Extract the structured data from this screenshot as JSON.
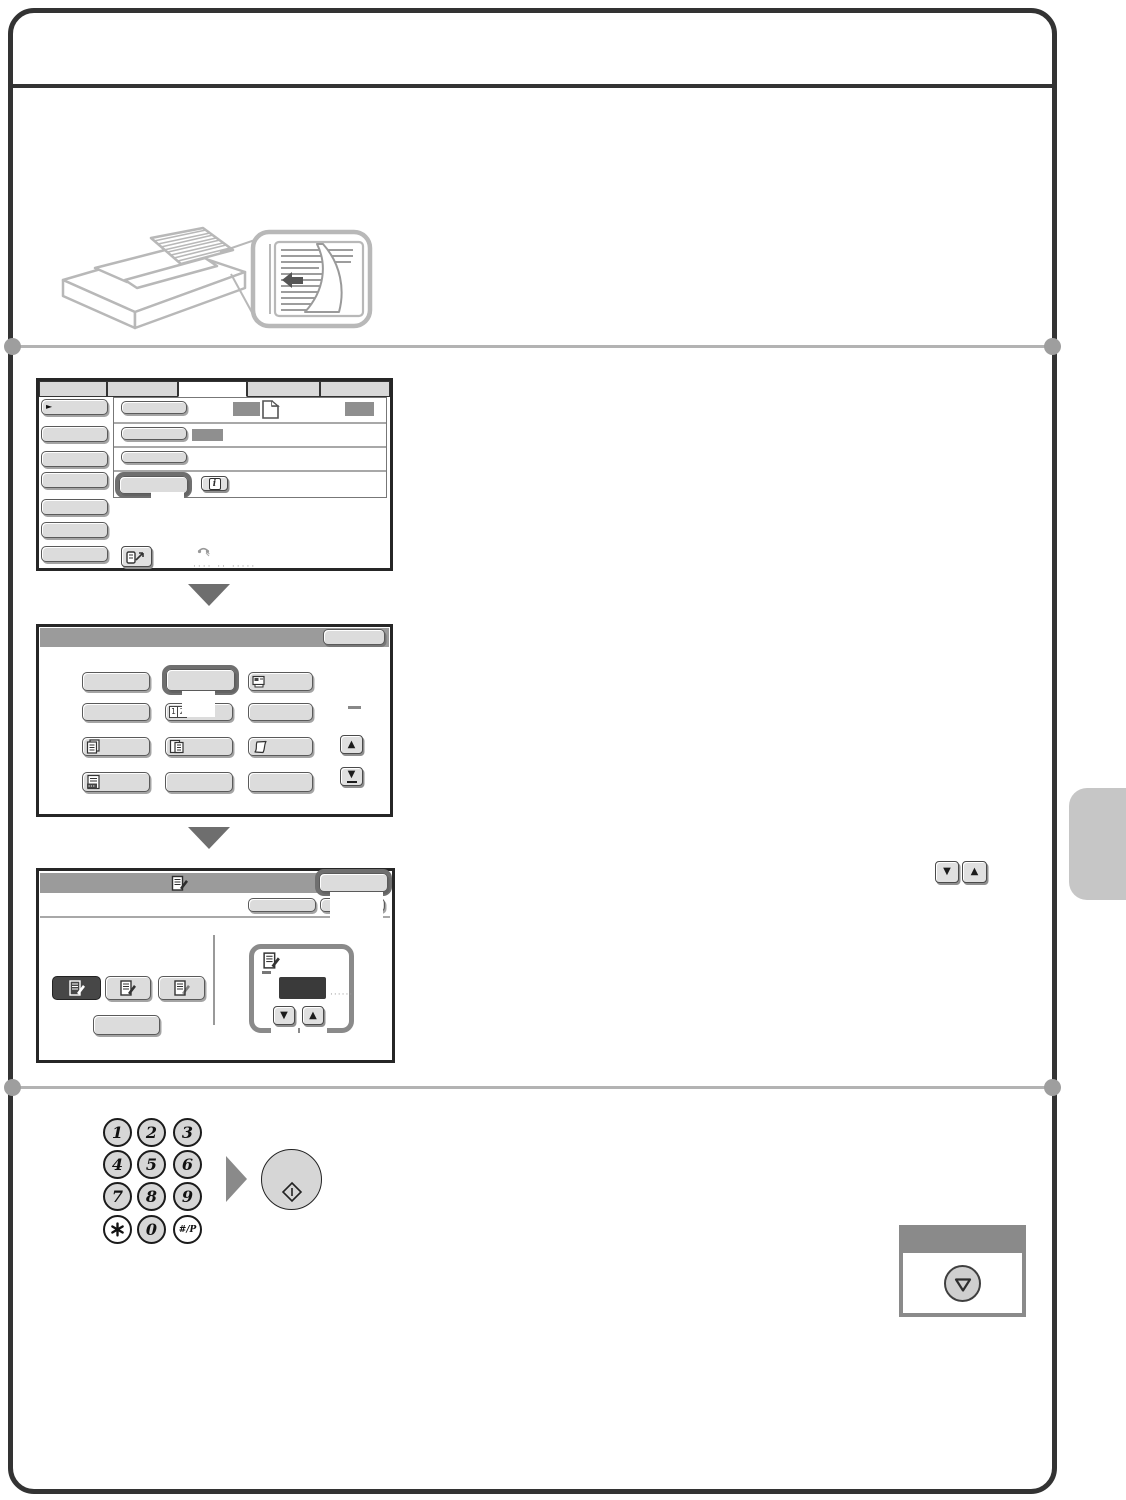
{
  "page": {
    "background": "#ffffff",
    "frame_border": "#333333",
    "divider_color": "#b3b3b3",
    "side_tab_color": "#c6c6c6"
  },
  "icons": {
    "up_arrow": "▲",
    "down_arrow": "▼",
    "menu_pointer": "►",
    "info": "i",
    "page_one": "1",
    "page_two": "2",
    "dash": "—"
  },
  "illustration": {
    "name": "document-feeder-with-original-direction-callout"
  },
  "screen1": {
    "name": "base-screen",
    "tabs": {
      "count": 5,
      "selected_index": 2
    },
    "left_menu_button_count": 7,
    "row_values": [
      "gray-box",
      "document-icon",
      "gray-box",
      "gray-box"
    ],
    "highlighted_row": 3,
    "address_dots": "···· ·· ·····"
  },
  "screen2": {
    "name": "special-modes-menu",
    "has_ok_button": true,
    "grid_icons": [
      [
        "plain",
        "highlighted",
        "id-card-icon"
      ],
      [
        "plain",
        "pages-1-2-icon",
        "plain"
      ],
      [
        "copies-icon",
        "originals-icon",
        "thin-paper-icon"
      ],
      [
        "file-icon",
        "plain",
        "plain"
      ]
    ],
    "scroll_keys": [
      "up",
      "down"
    ]
  },
  "screen3": {
    "name": "mode-setting-screen",
    "ok_button_highlighted": true,
    "mode_keys": [
      "selected-dark",
      "light",
      "light"
    ],
    "counter_dots": "······"
  },
  "keypad": {
    "keys": [
      "1",
      "2",
      "3",
      "4",
      "5",
      "6",
      "7",
      "8",
      "9",
      "*",
      "0",
      "#/P"
    ]
  },
  "start_key": {
    "icon": "start-diamond"
  },
  "stop_panel": {
    "icon": "stop-triangle"
  }
}
